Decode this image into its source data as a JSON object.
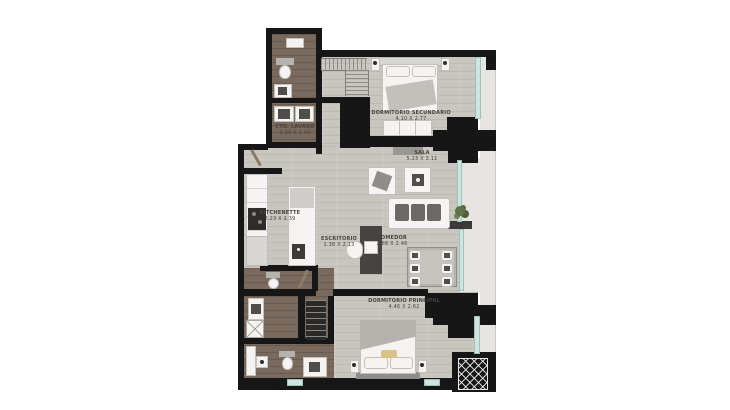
{
  "title": "Apartment floor plan",
  "rooms": {
    "cto_lavado": {
      "name": "CTO. LAVADO",
      "dims": "1.38 X 1.40"
    },
    "dormitorio_secundario": {
      "name": "DORMITORIO SECUNDARIO",
      "dims": "4.10 X 2.77"
    },
    "sala": {
      "name": "SALA",
      "dims": "5.23 X 3.11"
    },
    "kitchenette": {
      "name": "KITCHENETTE",
      "dims": "3.23 X 2.39"
    },
    "escritorio": {
      "name": "ESCRITORIO",
      "dims": "2.38 X 2.13"
    },
    "comedor": {
      "name": "COMEDOR",
      "dims": "2.88 X 2.46"
    },
    "dormitorio_principal": {
      "name": "DORMITORIO PRINCIPAL",
      "dims": "4.46 X 2.62"
    }
  },
  "colors": {
    "wall": "#161616",
    "floor_light": "#c9c6c0",
    "floor_dark": "#7a6a5d",
    "balcony": "#e6e5e1",
    "window_glass": "#cfe4df",
    "furniture_white": "#f5f4f2",
    "furniture_dark": "#504e4a",
    "accent_pillow": "#d9c386",
    "plant_green": "#5d7245",
    "label_text": "#45433e"
  }
}
